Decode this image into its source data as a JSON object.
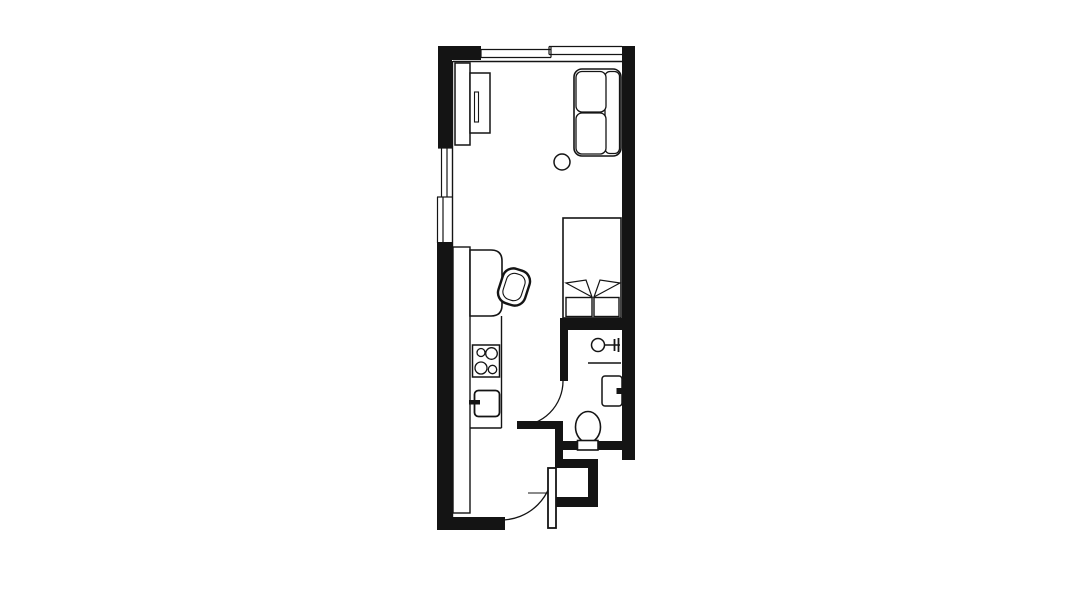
{
  "canvas": {
    "width": 1092,
    "height": 614,
    "background": "#ffffff",
    "line_color": "#141414"
  },
  "floorplan": {
    "type": "studio-apartment-plan",
    "elements": [
      {
        "type": "rect",
        "name": "wall-top-left-corner",
        "x": 438,
        "y": 46,
        "w": 43,
        "h": 14,
        "fill": "line"
      },
      {
        "type": "rect",
        "name": "wall-left-upper",
        "x": 438,
        "y": 46,
        "w": 14,
        "h": 102,
        "fill": "line"
      },
      {
        "type": "rect",
        "name": "wall-left-lower",
        "x": 437,
        "y": 242,
        "w": 15,
        "h": 288,
        "fill": "line"
      },
      {
        "type": "rect",
        "name": "wall-bottom",
        "x": 437,
        "y": 517,
        "w": 68,
        "h": 13,
        "fill": "line"
      },
      {
        "type": "rect",
        "name": "wall-right",
        "x": 622,
        "y": 46,
        "w": 13,
        "h": 414,
        "fill": "line"
      },
      {
        "type": "rect",
        "name": "wall-bed-bathroom",
        "x": 560,
        "y": 318,
        "w": 75,
        "h": 12,
        "fill": "line"
      },
      {
        "type": "rect",
        "name": "wall-bathroom-left",
        "x": 560,
        "y": 318,
        "w": 8,
        "h": 63,
        "fill": "line"
      },
      {
        "type": "rect",
        "name": "bathroom-door-leaf",
        "x": 517,
        "y": 421,
        "w": 46,
        "h": 8,
        "fill": "line"
      },
      {
        "type": "rect",
        "name": "wall-door-stub",
        "x": 555,
        "y": 429,
        "w": 8,
        "h": 33,
        "fill": "line"
      },
      {
        "type": "rect",
        "name": "wall-bathroom-bottom",
        "x": 563,
        "y": 441,
        "w": 72,
        "h": 9,
        "fill": "line"
      },
      {
        "type": "rect",
        "name": "wall-entry-step-top",
        "x": 555,
        "y": 459,
        "w": 43,
        "h": 9,
        "fill": "line"
      },
      {
        "type": "rect",
        "name": "wall-entry-step-right",
        "x": 588,
        "y": 459,
        "w": 10,
        "h": 48,
        "fill": "line"
      },
      {
        "type": "rect",
        "name": "wall-entry-step-bottom",
        "x": 555,
        "y": 497,
        "w": 43,
        "h": 10,
        "fill": "line"
      },
      {
        "type": "line",
        "name": "inner-wall-top",
        "x1": 453,
        "y1": 61.5,
        "x2": 622,
        "y2": 61.5,
        "sw": 1.4
      },
      {
        "type": "line",
        "name": "inner-wall-left",
        "x1": 452.5,
        "y1": 61,
        "x2": 452.5,
        "y2": 517,
        "sw": 1.4
      },
      {
        "type": "line",
        "name": "window-top-1-outer",
        "x1": 481,
        "y1": 49.5,
        "x2": 551,
        "y2": 49.5,
        "sw": 1.2
      },
      {
        "type": "line",
        "name": "window-top-1-inner",
        "x1": 481,
        "y1": 57.5,
        "x2": 551,
        "y2": 57.5,
        "sw": 1.2
      },
      {
        "type": "line",
        "name": "window-top-1-tick-left",
        "x1": 481,
        "y1": 49.5,
        "x2": 481,
        "y2": 57.5,
        "sw": 1.2
      },
      {
        "type": "line",
        "name": "window-top-jog",
        "x1": 551,
        "y1": 46.5,
        "x2": 551,
        "y2": 57.5,
        "sw": 1.2
      },
      {
        "type": "line",
        "name": "window-top-2-outer",
        "x1": 549,
        "y1": 46.5,
        "x2": 622,
        "y2": 46.5,
        "sw": 1.2
      },
      {
        "type": "line",
        "name": "window-top-2-inner",
        "x1": 549,
        "y1": 54.5,
        "x2": 622,
        "y2": 54.5,
        "sw": 1.2
      },
      {
        "type": "line",
        "name": "window-top-2-tick-left",
        "x1": 549,
        "y1": 46.5,
        "x2": 549,
        "y2": 54.5,
        "sw": 1.2
      },
      {
        "type": "line",
        "name": "window-left-1-outer",
        "x1": 441.5,
        "y1": 148,
        "x2": 441.5,
        "y2": 197,
        "sw": 1.2
      },
      {
        "type": "line",
        "name": "window-left-1-inner",
        "x1": 447,
        "y1": 148,
        "x2": 447,
        "y2": 197,
        "sw": 1.2
      },
      {
        "type": "line",
        "name": "window-left-tick-top",
        "x1": 438,
        "y1": 148,
        "x2": 452,
        "y2": 148,
        "sw": 1.2
      },
      {
        "type": "line",
        "name": "window-left-tick-mid",
        "x1": 437,
        "y1": 197,
        "x2": 452,
        "y2": 197,
        "sw": 1.2
      },
      {
        "type": "line",
        "name": "window-left-2-outer",
        "x1": 437.5,
        "y1": 197,
        "x2": 437.5,
        "y2": 243,
        "sw": 1.2
      },
      {
        "type": "line",
        "name": "window-left-2-inner",
        "x1": 443,
        "y1": 197,
        "x2": 443,
        "y2": 243,
        "sw": 1.2
      },
      {
        "type": "line",
        "name": "window-left-tick-bottom",
        "x1": 437,
        "y1": 243,
        "x2": 452,
        "y2": 243,
        "sw": 1.2
      },
      {
        "type": "rect",
        "name": "wardrobe-back",
        "x": 455,
        "y": 63,
        "w": 15,
        "h": 82,
        "fill": "white",
        "sw": 1.5
      },
      {
        "type": "rect",
        "name": "wardrobe-front",
        "x": 470,
        "y": 73,
        "w": 20,
        "h": 60,
        "fill": "white",
        "sw": 1.5
      },
      {
        "type": "rect",
        "name": "wardrobe-slot",
        "x": 474.5,
        "y": 92,
        "w": 4,
        "h": 30,
        "fill": "white",
        "sw": 1.1
      },
      {
        "type": "rect",
        "name": "sofa-body",
        "x": 574,
        "y": 69,
        "w": 47,
        "h": 87,
        "rx": 8,
        "fill": "white",
        "sw": 1.6
      },
      {
        "type": "rect",
        "name": "sofa-backrest",
        "x": 605,
        "y": 71.5,
        "w": 14.5,
        "h": 82,
        "rx": 5,
        "fill": "white",
        "sw": 1.3
      },
      {
        "type": "rect",
        "name": "sofa-cushion-1",
        "x": 576,
        "y": 71.5,
        "w": 30,
        "h": 40.5,
        "rx": 6,
        "fill": "white",
        "sw": 1.3
      },
      {
        "type": "rect",
        "name": "sofa-cushion-2",
        "x": 576,
        "y": 113,
        "w": 30,
        "h": 41,
        "rx": 6,
        "fill": "white",
        "sw": 1.3
      },
      {
        "type": "circle",
        "name": "side-table",
        "cx": 562,
        "cy": 162,
        "r": 8,
        "fill": "white",
        "sw": 1.5
      },
      {
        "type": "rect",
        "name": "bed",
        "x": 563,
        "y": 218,
        "w": 58,
        "h": 100,
        "fill": "white",
        "sw": 1.6
      },
      {
        "type": "polygon",
        "name": "bed-fold-left",
        "points": "592,297 566,283 586,280",
        "fill": "white",
        "sw": 1.2
      },
      {
        "type": "polygon",
        "name": "bed-fold-right",
        "points": "594,297 620,283 600,280",
        "fill": "white",
        "sw": 1.2
      },
      {
        "type": "rect",
        "name": "bed-pillow-1",
        "x": 566,
        "y": 297.5,
        "w": 26,
        "h": 19,
        "fill": "white",
        "sw": 1.4
      },
      {
        "type": "rect",
        "name": "bed-pillow-2",
        "x": 594,
        "y": 297.5,
        "w": 25,
        "h": 19,
        "fill": "white",
        "sw": 1.4
      },
      {
        "type": "rect",
        "name": "kitchen-counter",
        "x": 453,
        "y": 247,
        "w": 17,
        "h": 266,
        "fill": "white",
        "sw": 1.4
      },
      {
        "type": "path",
        "name": "kitchen-desk",
        "d": "M470,250 H491 Q502,250 502,261 V305 Q502,316 491,316 H470 Z",
        "fill": "white",
        "sw": 1.6
      },
      {
        "type": "line",
        "name": "kitchen-front-edge",
        "x1": 501.5,
        "y1": 316,
        "x2": 501.5,
        "y2": 428,
        "sw": 1.4
      },
      {
        "type": "line",
        "name": "kitchen-block-bottom",
        "x1": 470,
        "y1": 428,
        "x2": 501.5,
        "y2": 428,
        "sw": 1.4
      },
      {
        "type": "rect",
        "name": "desk-chair-outer",
        "x": 500,
        "y": 269,
        "w": 28,
        "h": 36,
        "rx": 11,
        "fill": "white",
        "sw": 2.4,
        "tr": "rotate(18 514 287)"
      },
      {
        "type": "rect",
        "name": "desk-chair-inner",
        "x": 504.5,
        "y": 273.5,
        "w": 19,
        "h": 27,
        "rx": 8,
        "fill": "none",
        "sw": 1.1,
        "tr": "rotate(18 514 287)"
      },
      {
        "type": "rect",
        "name": "stove",
        "x": 472.5,
        "y": 345,
        "w": 27,
        "h": 32,
        "fill": "white",
        "sw": 1.5
      },
      {
        "type": "circle",
        "name": "burner-top-left",
        "cx": 481,
        "cy": 352.5,
        "r": 4,
        "fill": "white",
        "sw": 1.3
      },
      {
        "type": "circle",
        "name": "burner-top-right",
        "cx": 491.5,
        "cy": 353.5,
        "r": 5.8,
        "fill": "white",
        "sw": 1.3
      },
      {
        "type": "circle",
        "name": "burner-bottom-left",
        "cx": 481,
        "cy": 368,
        "r": 6,
        "fill": "white",
        "sw": 1.3
      },
      {
        "type": "circle",
        "name": "burner-bottom-right",
        "cx": 492.5,
        "cy": 369.5,
        "r": 4.2,
        "fill": "white",
        "sw": 1.3
      },
      {
        "type": "rect",
        "name": "kitchen-sink",
        "x": 474.5,
        "y": 390.5,
        "w": 25,
        "h": 26,
        "rx": 4,
        "fill": "white",
        "sw": 1.8
      },
      {
        "type": "rect",
        "name": "sink-faucet",
        "x": 469,
        "y": 400,
        "w": 11,
        "h": 4.5,
        "fill": "line"
      },
      {
        "type": "circle",
        "name": "basin",
        "cx": 598,
        "cy": 345,
        "r": 6.5,
        "fill": "white",
        "sw": 1.5
      },
      {
        "type": "line",
        "name": "basin-stem",
        "x1": 604.5,
        "y1": 345,
        "x2": 620,
        "y2": 345,
        "sw": 1.5
      },
      {
        "type": "line",
        "name": "basin-tick-1",
        "x1": 614.5,
        "y1": 339,
        "x2": 614.5,
        "y2": 351,
        "sw": 1.8
      },
      {
        "type": "line",
        "name": "basin-tick-2",
        "x1": 618.5,
        "y1": 338,
        "x2": 618.5,
        "y2": 352,
        "sw": 1.8
      },
      {
        "type": "line",
        "name": "bathroom-shelf",
        "x1": 588,
        "y1": 363,
        "x2": 621,
        "y2": 363,
        "sw": 1.4
      },
      {
        "type": "rect",
        "name": "shower",
        "x": 602,
        "y": 376,
        "w": 20,
        "h": 30,
        "rx": 3,
        "fill": "white",
        "sw": 1.5
      },
      {
        "type": "rect",
        "name": "shower-tab",
        "x": 616.5,
        "y": 388,
        "w": 7.5,
        "h": 6,
        "fill": "line"
      },
      {
        "type": "ellipse",
        "name": "toilet-bowl",
        "cx": 588,
        "cy": 427,
        "rx": 12.5,
        "ry": 15.5,
        "fill": "white",
        "sw": 1.6
      },
      {
        "type": "rect",
        "name": "toilet-tank",
        "x": 577.5,
        "y": 440.5,
        "w": 20.5,
        "h": 9.5,
        "fill": "white",
        "sw": 1.6
      },
      {
        "type": "path",
        "name": "bathroom-door-arc",
        "d": "M518,426 A45,45 0 0 0 563,381",
        "fill": "none",
        "sw": 1.3
      },
      {
        "type": "path",
        "name": "entry-door-arc",
        "d": "M501,520 A52,52 0 0 0 553,468",
        "fill": "none",
        "sw": 1.3
      },
      {
        "type": "rect",
        "name": "entry-door-leaf",
        "x": 548,
        "y": 468,
        "w": 8,
        "h": 60,
        "fill": "white",
        "sw": 1.8
      },
      {
        "type": "line",
        "name": "entry-threshold-line",
        "x1": 528,
        "y1": 493,
        "x2": 548,
        "y2": 493,
        "sw": 1.1
      }
    ]
  }
}
